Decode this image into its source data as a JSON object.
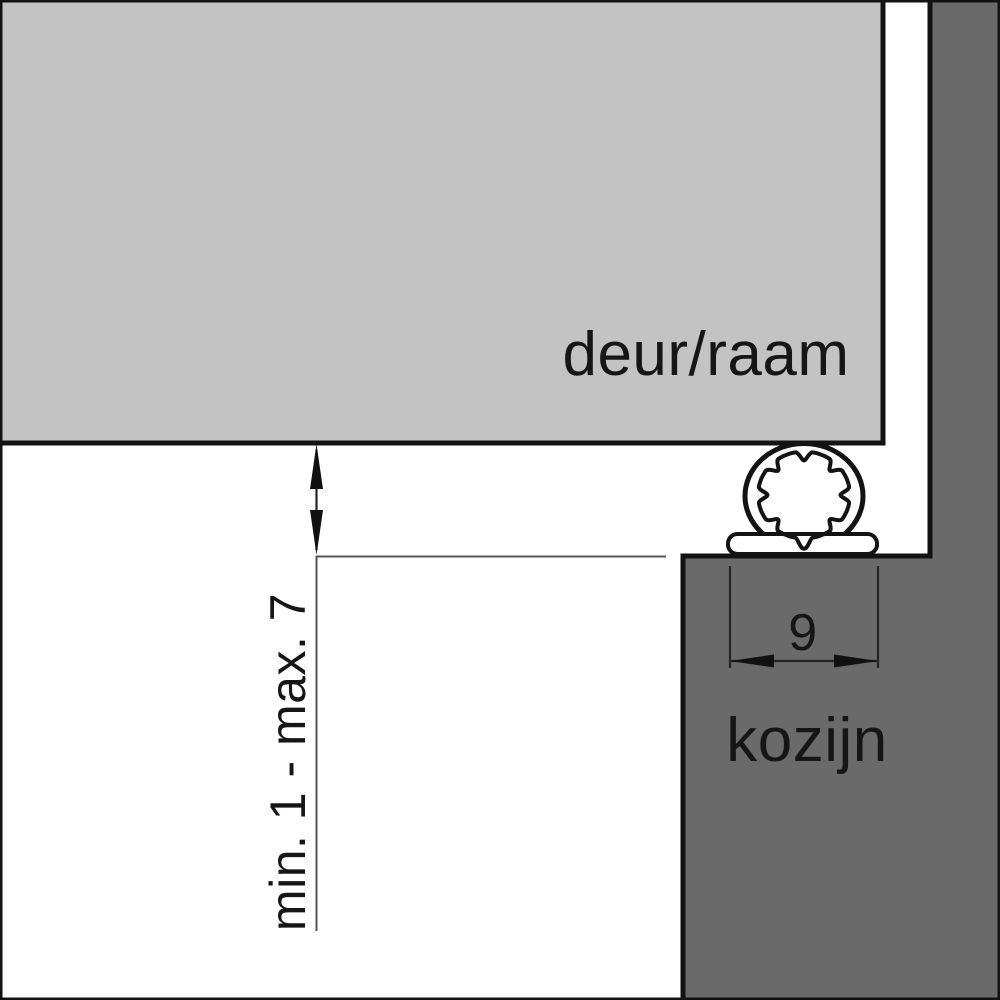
{
  "diagram": {
    "title_context": "weatherseal installation cross-section",
    "labels": {
      "door": "deur/raam",
      "frame": "kozijn",
      "gap_dimension": "min. 1 - max. 7",
      "seal_width_dimension": "9"
    },
    "colors": {
      "door_fill": "#c3c3c3",
      "frame_fill": "#6a6a6a",
      "seal_fill": "#ffffff",
      "outline": "#131313",
      "background": "#ffffff",
      "thin_line": "#555555",
      "text": "#161616"
    }
  }
}
